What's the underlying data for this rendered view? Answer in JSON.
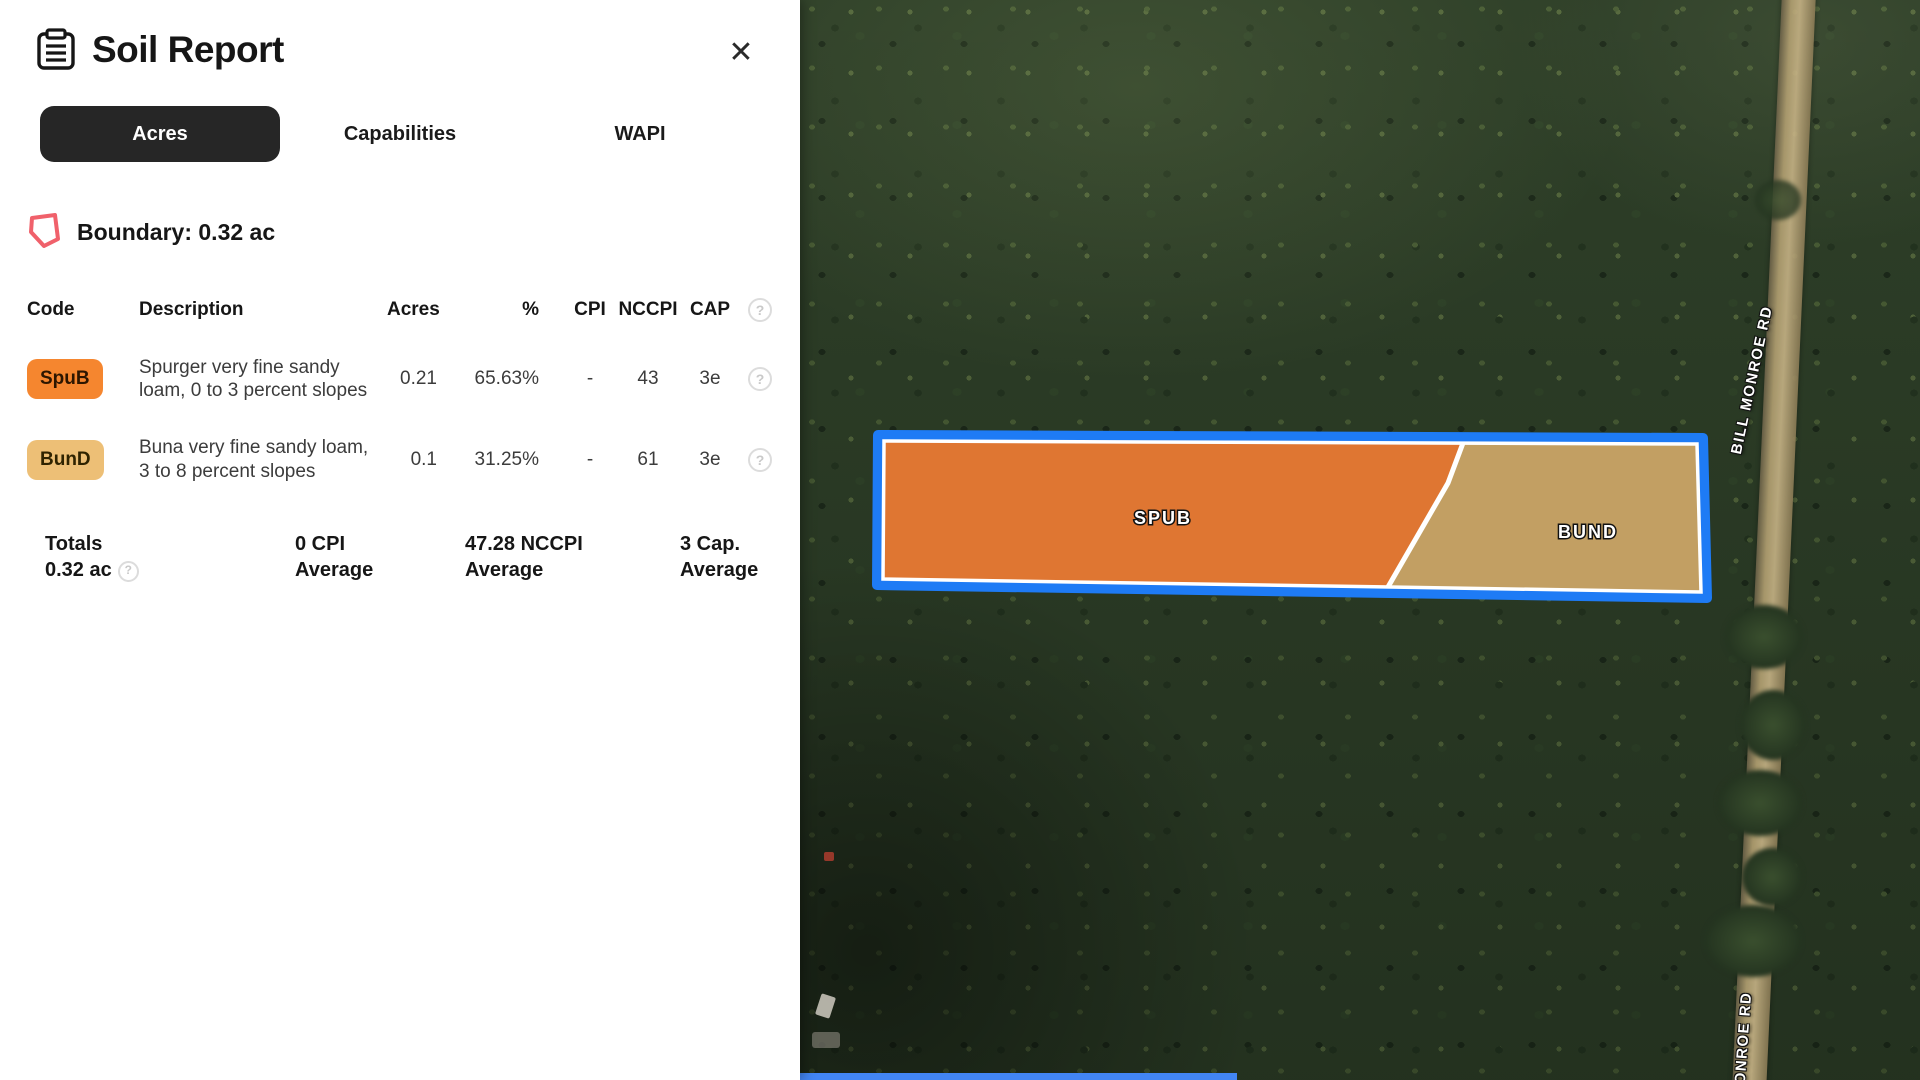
{
  "panel": {
    "title": "Soil Report",
    "close_glyph": "✕",
    "help_glyph": "?",
    "tabs": [
      {
        "label": "Acres",
        "active": true
      },
      {
        "label": "Capabilities",
        "active": false
      },
      {
        "label": "WAPI",
        "active": false
      }
    ],
    "boundary_label": "Boundary: 0.32 ac",
    "table": {
      "headers": {
        "code": "Code",
        "description": "Description",
        "acres": "Acres",
        "percent": "%",
        "cpi": "CPI",
        "nccpi": "NCCPI",
        "cap": "CAP"
      },
      "rows": [
        {
          "code": "SpuB",
          "badge_color": "#F5862F",
          "description": "Spurger very fine sandy loam, 0 to 3 percent slopes",
          "acres": "0.21",
          "percent": "65.63%",
          "cpi": "-",
          "nccpi": "43",
          "cap": "3e"
        },
        {
          "code": "BunD",
          "badge_color": "#EDBF76",
          "description": "Buna very fine sandy loam, 3 to 8 percent slopes",
          "acres": "0.1",
          "percent": "31.25%",
          "cpi": "-",
          "nccpi": "61",
          "cap": "3e"
        }
      ],
      "totals": {
        "title": "Totals",
        "acres": "0.32 ac",
        "cpi_value": "0 CPI",
        "cpi_label": "Average",
        "nccpi_value": "47.28 NCCPI",
        "nccpi_label": "Average",
        "cap_value": "3 Cap.",
        "cap_label": "Average"
      }
    }
  },
  "map": {
    "type": "satellite",
    "parcel": {
      "outline_color": "#1E7BF5",
      "inner_outline_color": "#FFFFFF",
      "regions": [
        {
          "label": "SPUB",
          "fill": "#E87B35"
        },
        {
          "label": "BUND",
          "fill": "#C9A76A"
        }
      ]
    },
    "road_labels": [
      "BILL MONROE RD",
      "MONROE RD"
    ],
    "scrollbar_color": "#4285F4"
  }
}
